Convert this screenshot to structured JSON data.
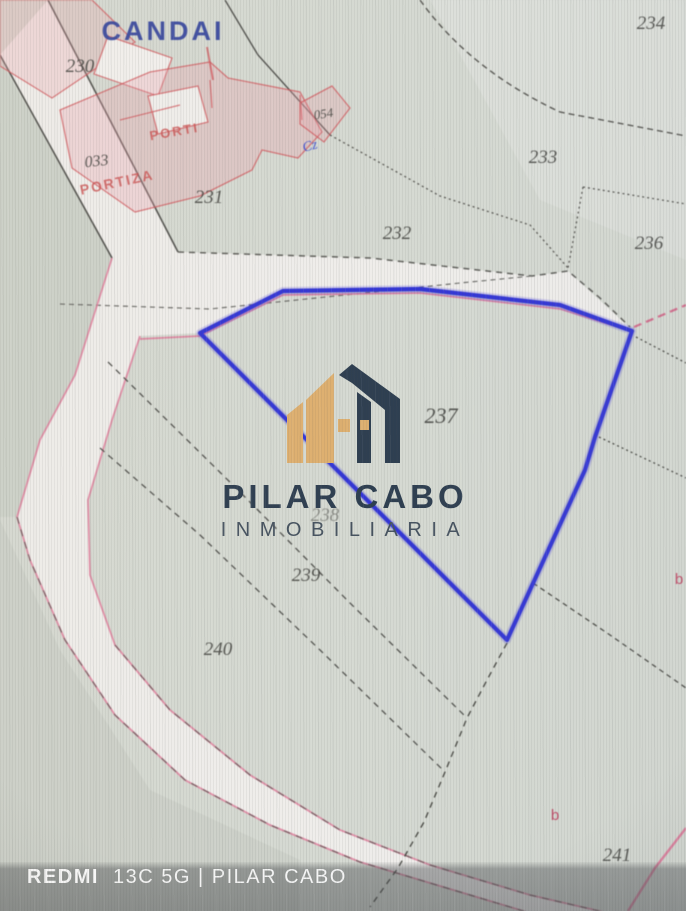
{
  "map": {
    "place_label": "CANDAI",
    "highlighted_parcel": "237",
    "parcel_labels": [
      {
        "id": "230"
      },
      {
        "id": "033"
      },
      {
        "id": "231"
      },
      {
        "id": "232"
      },
      {
        "id": "233"
      },
      {
        "id": "234"
      },
      {
        "id": "236"
      },
      {
        "id": "237"
      },
      {
        "id": "238"
      },
      {
        "id": "239"
      },
      {
        "id": "240"
      },
      {
        "id": "241"
      },
      {
        "id": "054"
      }
    ],
    "red_place_labels": [
      {
        "text": "PORTI"
      },
      {
        "text": "PORTIZA"
      }
    ],
    "subparcel_labels": [
      {
        "text": "b"
      },
      {
        "text": "b"
      }
    ],
    "blue_annotation": "Cz",
    "colors": {
      "selection_blue": "#2b2ed6",
      "boundary_pink": "#e07a9a",
      "building_red": "#d25055",
      "road_white": "#f1efec",
      "background": "#d6dad2",
      "label_dark": "#3b3b37",
      "place_blue": "#2b3c9b"
    }
  },
  "logo": {
    "name": "PILAR CABO",
    "subtitle": "INMOBILIARIA",
    "navy": "#26374a",
    "gold": "#dfae6b"
  },
  "watermark": {
    "device": "REDMI",
    "caption": "13C 5G | PILAR CABO"
  }
}
